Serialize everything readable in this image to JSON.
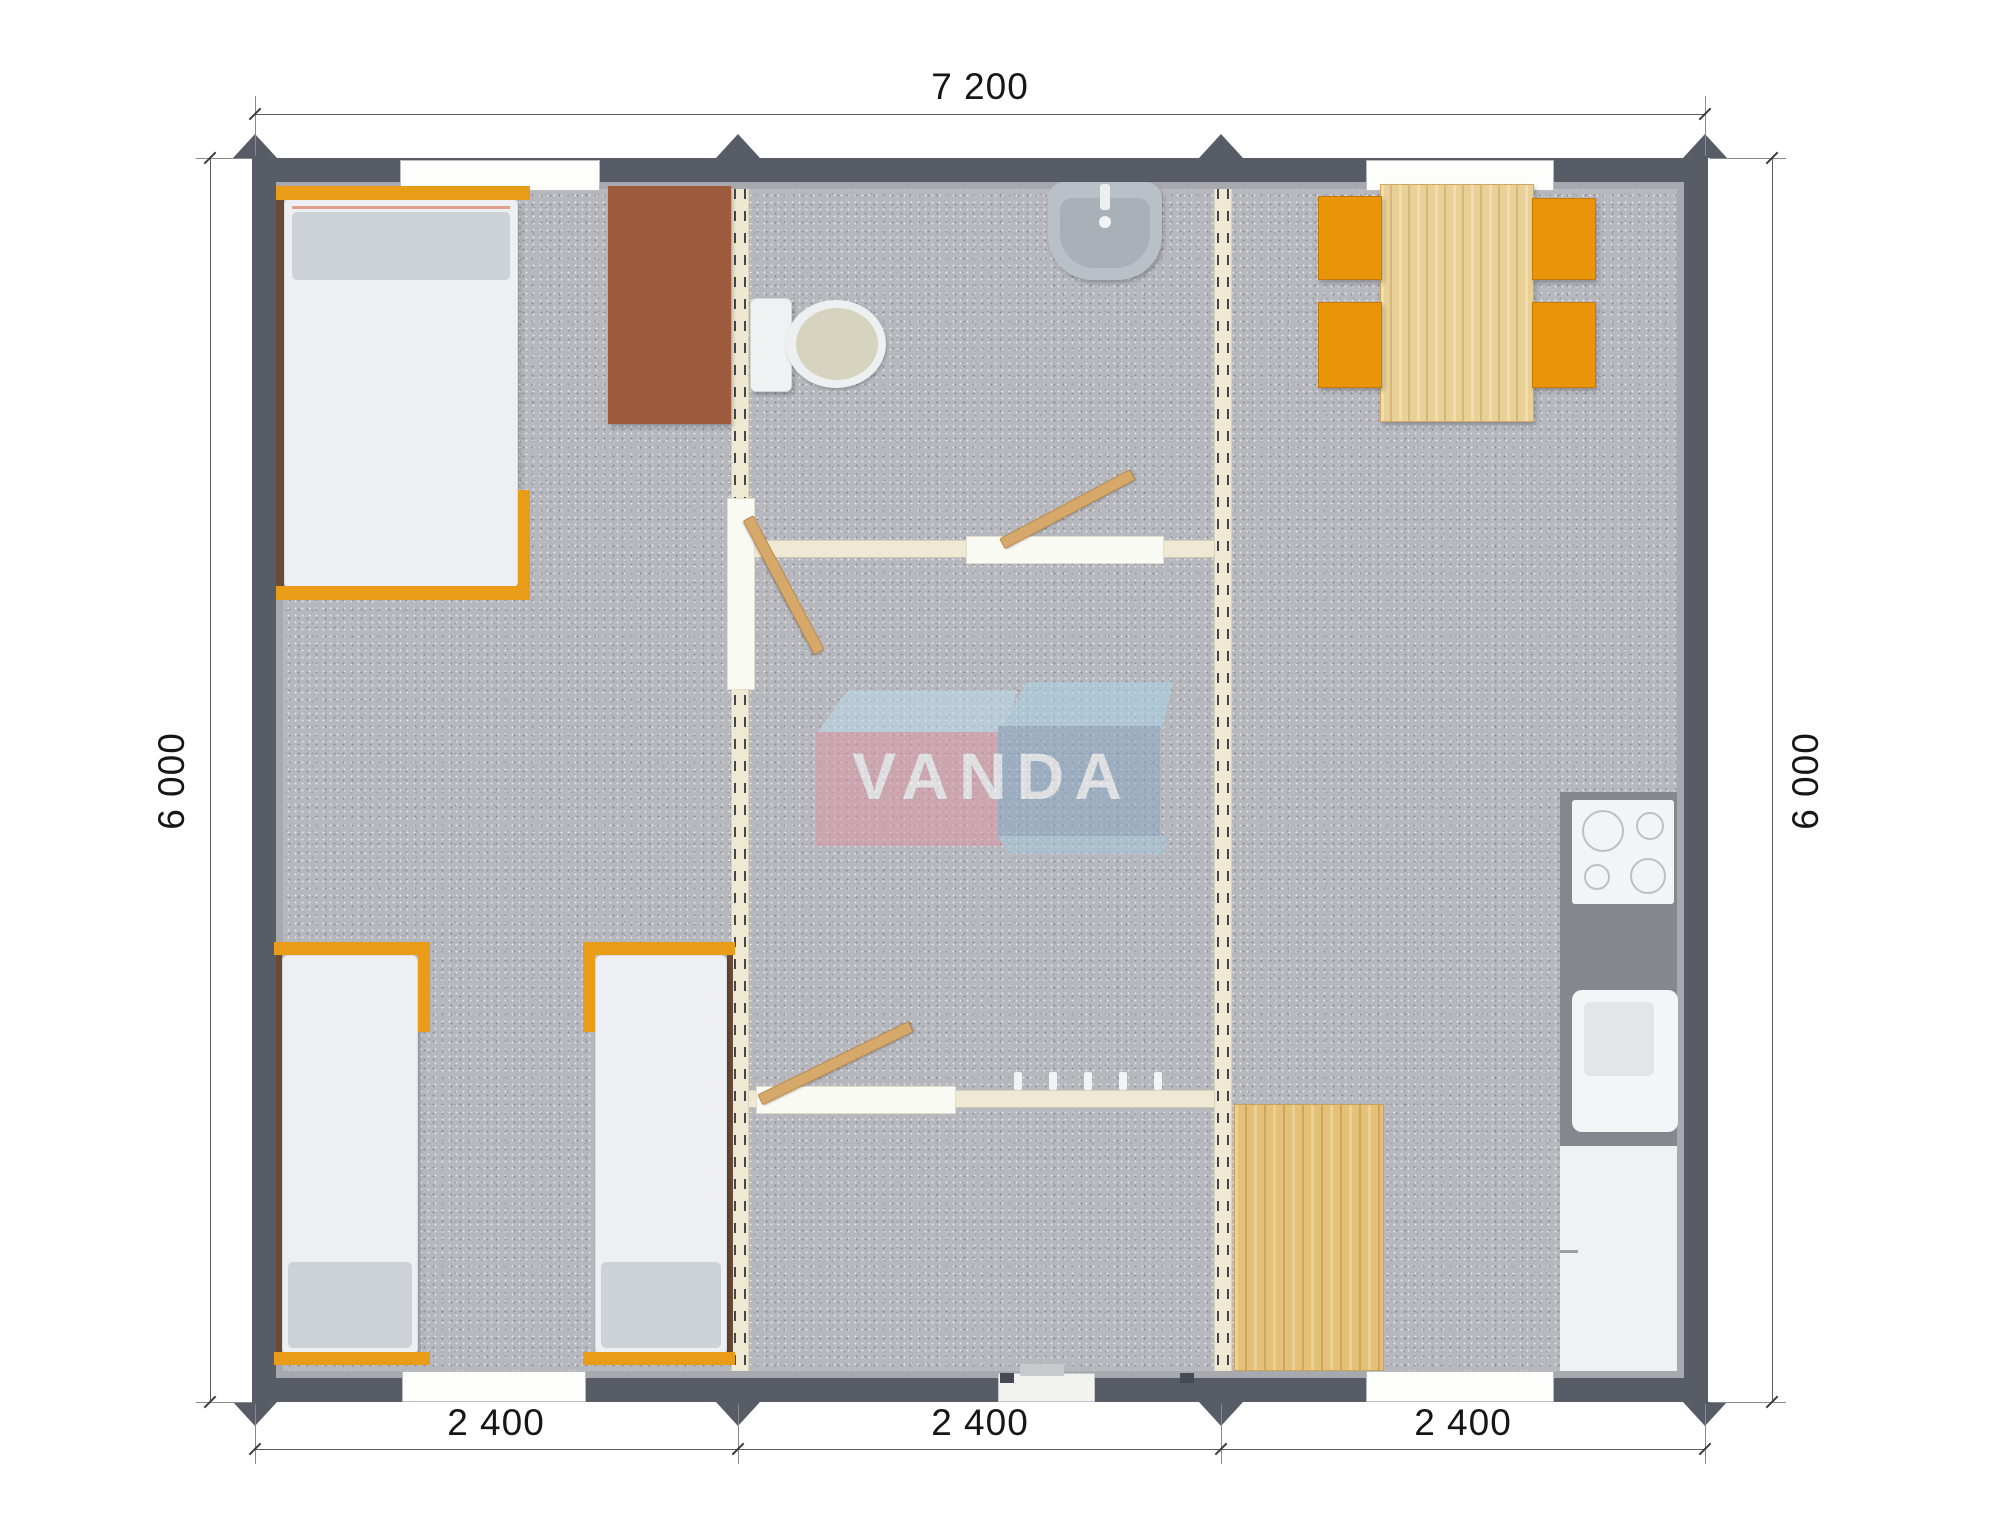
{
  "plan": {
    "type": "floor-plan",
    "description": "Top-down 3D render of a 7200x6000 modular building with three 2400 modules: bedroom with three beds, central bathroom/hall, kitchen-dining room"
  },
  "dimensions": {
    "top": "7 200",
    "left": "6 000",
    "right": "6 000",
    "bottom": [
      "2 400",
      "2 400",
      "2 400"
    ]
  },
  "watermark": {
    "text": "VANDA"
  },
  "palette": {
    "wall_outer": "#585c67",
    "wall_liner": "#a7a9af",
    "floor": "#b7b8be",
    "partition_cream": "#efe8d2",
    "furniture_orange": "#e99c17",
    "chair_orange": "#ea9408",
    "wood_light": "#e9d096",
    "wood_deep": "#e4c176",
    "cabinet_brown": "#9d5a3c",
    "logo_red": "#de99a2",
    "logo_blue": "#8ba7c5",
    "logo_light_blue": "#aed6e8"
  },
  "furniture_icons": [
    "single-bed-icon",
    "pillow-icon",
    "wardrobe-icon",
    "toilet-icon",
    "washbasin-icon",
    "interior-door-icon",
    "coat-hooks-icon",
    "dining-table-icon",
    "chair-icon",
    "cooktop-icon",
    "kitchen-sink-icon",
    "kitchen-cabinet-icon",
    "wood-mat-icon",
    "window-icon",
    "entrance-step-icon",
    "module-corner-icon"
  ]
}
